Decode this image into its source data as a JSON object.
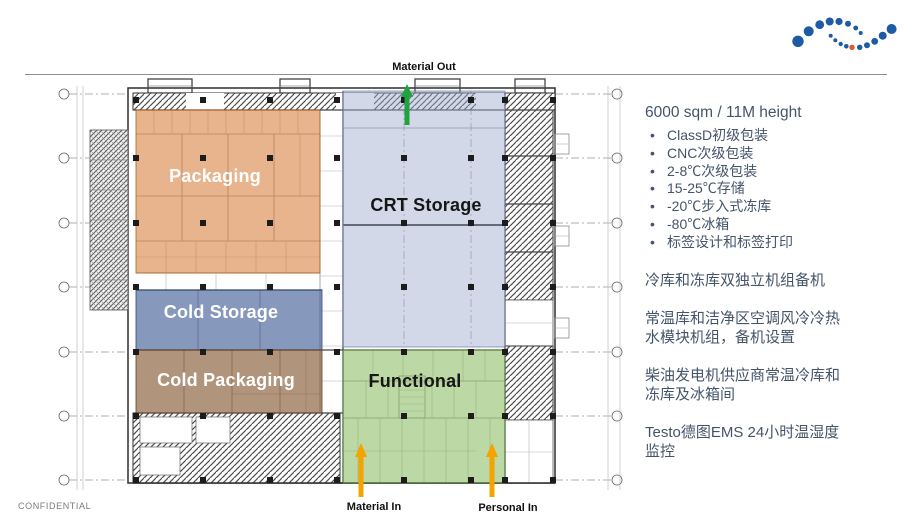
{
  "slide": {
    "confidential": "CONFIDENTIAL"
  },
  "logo": {
    "brand_blue": "#1D5BA4",
    "accent_orange": "#E05A2B"
  },
  "floorplan": {
    "zones": [
      {
        "id": "packaging",
        "label": "Packaging",
        "color": "rgba(216,126,58,0.58)"
      },
      {
        "id": "crt-storage",
        "label": "CRT Storage",
        "color": "rgba(156,168,204,0.45)"
      },
      {
        "id": "cold-storage",
        "label": "Cold Storage",
        "color": "rgba(62,88,148,0.62)"
      },
      {
        "id": "cold-packaging",
        "label": "Cold Packaging",
        "color": "rgba(128,82,44,0.62)"
      },
      {
        "id": "functional",
        "label": "Functional",
        "color": "rgba(124,180,82,0.52)"
      }
    ],
    "flows": [
      {
        "id": "material-out",
        "label": "Material Out",
        "color": "#1FA33C"
      },
      {
        "id": "material-in",
        "label": "Material In",
        "color": "#F5A300"
      },
      {
        "id": "personal-in",
        "label": "Personal In",
        "color": "#F5A300"
      }
    ]
  },
  "specs": {
    "heading": "6000 sqm / 11M height",
    "text_color": "#44546A",
    "bullets": [
      "ClassD初级包装",
      "CNC次级包装",
      "2-8℃次级包装",
      "15-25℃存储",
      "-20℃步入式冻库",
      "-80℃冰箱",
      "标签设计和标签打印"
    ],
    "paragraphs": [
      "冷库和冻库双独立机组备机",
      "常温库和洁净区空调风冷冷热水模块机组，备机设置",
      "柴油发电机供应商常温冷库和冻库及冰箱间",
      "Testo德图EMS 24小时温湿度监控"
    ]
  }
}
